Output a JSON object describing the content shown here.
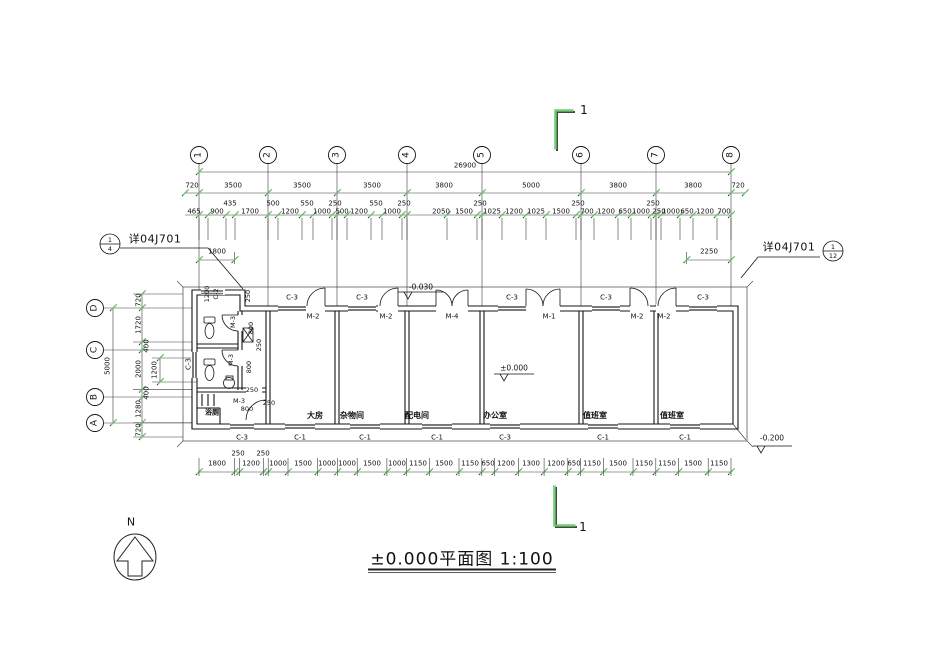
{
  "colors": {
    "line": "#1a1a1a",
    "accent_green": "#66c666",
    "window_fill": "#7a7a7a"
  },
  "title": {
    "text": "±0.000平面图  1:100"
  },
  "north_label": "N",
  "section_marks": {
    "top": "1",
    "bottom": "1"
  },
  "callouts": {
    "left": {
      "ref": "详04J701",
      "circle_top": "1",
      "circle_bottom": "4"
    },
    "right": {
      "ref": "详04J701",
      "circle_top": "1",
      "circle_bottom": "12"
    }
  },
  "grid": {
    "top": [
      "1",
      "2",
      "3",
      "4",
      "5",
      "6",
      "7",
      "8"
    ],
    "left": [
      "D",
      "C",
      "B",
      "A"
    ]
  },
  "dims": {
    "overall": "26900",
    "axis_row": [
      "720",
      "3500",
      "3500",
      "3500",
      "3800",
      "5000",
      "3800",
      "3800",
      "720"
    ],
    "detail_upper": [
      "435",
      "500",
      "550",
      "250",
      "550",
      "250",
      "250",
      "250",
      "250"
    ],
    "detail_lower": [
      "465",
      "900",
      "1700",
      "1200",
      "1000",
      "500",
      "1200",
      "1000",
      "2050",
      "1500",
      "1025",
      "1200",
      "1025",
      "1500",
      "700",
      "1200",
      "650",
      "1000",
      "250",
      "1000",
      "650",
      "1200",
      "700"
    ],
    "bottom_raised": [
      "250",
      "250"
    ],
    "bottom": [
      "1800",
      "1200",
      "1000",
      "1500",
      "1000",
      "1000",
      "1500",
      "1000",
      "1150",
      "1500",
      "1150",
      "650",
      "1200",
      "1300",
      "1200",
      "650",
      "1150",
      "1500",
      "1150",
      "1150",
      "1500",
      "1150"
    ],
    "left_overall": "5000",
    "left_inner": "1200",
    "left_chain": [
      "720",
      "1720",
      "400",
      "2000",
      "400",
      "1280",
      "720"
    ],
    "dim_1800": "1800",
    "dim_2250": "2250"
  },
  "plan": {
    "rooms": [
      "大房",
      "杂物间",
      "配电间",
      "办公室",
      "值班室",
      "值班室"
    ],
    "toilet_room": "浴厕",
    "top_windows": [
      "C-3",
      "C-3",
      "C-3",
      "C-3",
      "C-3"
    ],
    "top_doors": [
      "M-2",
      "M-2",
      "M-4",
      "M-1",
      "M-2",
      "M-2"
    ],
    "bottom_windows": [
      "C-3",
      "C-1",
      "C-1",
      "C-1",
      "C-3",
      "C-1",
      "C-1"
    ],
    "left_window": "C-3",
    "toilet_labels": {
      "w1200": "1200",
      "c2": "C-2",
      "d250a": "250",
      "m3a": "M-3",
      "d800a": "800",
      "d250b": "250",
      "m3b": "M-3",
      "d800b": "800",
      "m3c": "M-3",
      "d800c": "800",
      "d250c": "250",
      "d250d": "250"
    },
    "elevations": {
      "entry": "-0.030",
      "floor": "±0.000",
      "outside": "-0.200"
    }
  }
}
